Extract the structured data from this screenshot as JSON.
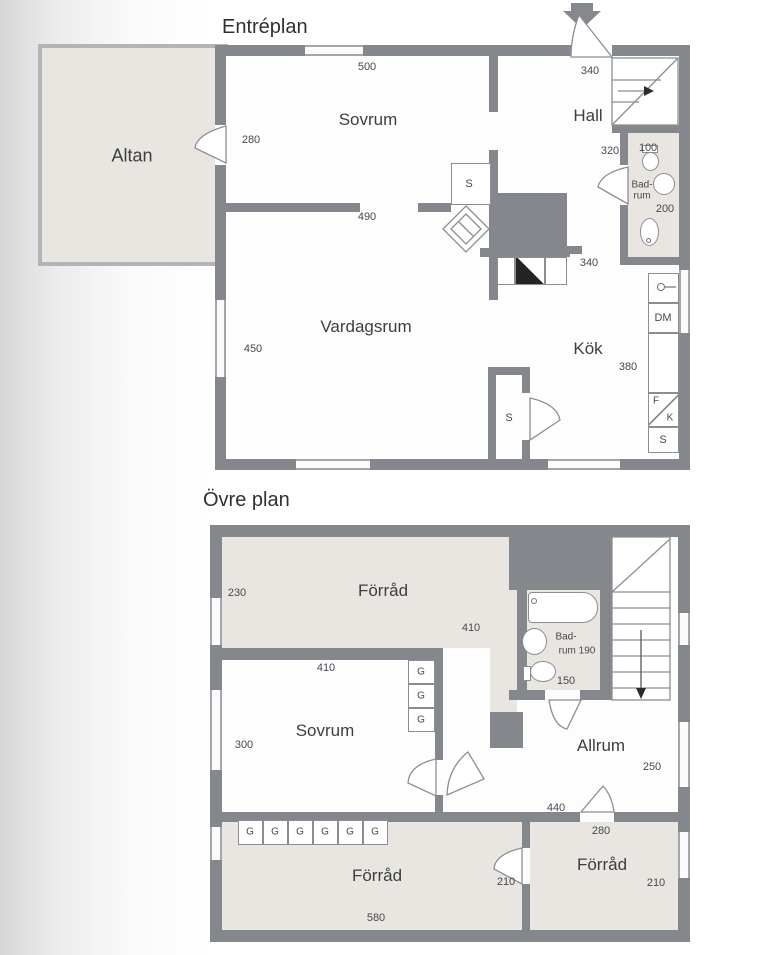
{
  "colors": {
    "wall": "#84878c",
    "room_beige": "#e9e6e1",
    "room_white": "#fdfdfe",
    "outline": "#8a8d91",
    "text": "#3b3f43"
  },
  "floor1": {
    "title": "Entréplan",
    "altan": "Altan",
    "sovrum": "Sovrum",
    "hall": "Hall",
    "vardagsrum": "Vardagsrum",
    "kok": "Kök",
    "badrum_l1": "Bad-",
    "badrum_l2": "rum",
    "s": "S",
    "dm": "DM",
    "f": "F",
    "k": "K",
    "d500": "500",
    "d340_hall": "340",
    "d280": "280",
    "d320": "320",
    "d100": "100",
    "d200": "200",
    "d490": "490",
    "d450": "450",
    "d340_kok": "340",
    "d380": "380"
  },
  "floor2": {
    "title": "Övre plan",
    "forrad": "Förråd",
    "sovrum": "Sovrum",
    "allrum": "Allrum",
    "badrum_l1": "Bad-",
    "badrum_l2": "rum 190",
    "g": "G",
    "d230": "230",
    "d410_forrad": "410",
    "d410_sovrum": "410",
    "d300": "300",
    "d150": "150",
    "d250": "250",
    "d440": "440",
    "d280": "280",
    "d210_l": "210",
    "d210_r": "210",
    "d580": "580"
  }
}
